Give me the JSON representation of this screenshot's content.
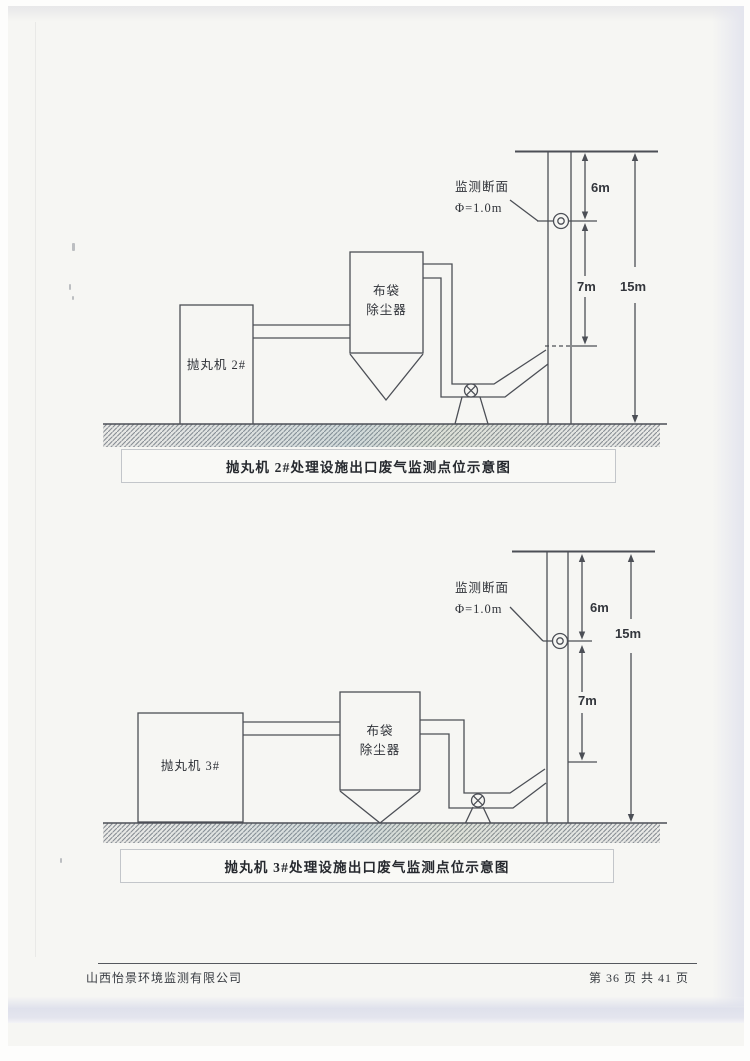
{
  "colors": {
    "paper": "#f6f6f3",
    "line": "#4c4f56",
    "text": "#2f3238",
    "caption_border": "#c3c6ca",
    "bottom_scan_band": "#dfe1ec",
    "ground_hatch": "#878c93"
  },
  "diagram1": {
    "monitor_section_label": "监测断面",
    "diameter_label": "Φ=1.0m",
    "dim_top": "6m",
    "dim_mid": "7m",
    "dim_total": "15m",
    "machine_label": "抛丸机 2#",
    "collector_label_1": "布袋",
    "collector_label_2": "除尘器",
    "caption": "抛丸机 2#处理设施出口废气监测点位示意图"
  },
  "diagram2": {
    "monitor_section_label": "监测断面",
    "diameter_label": "Φ=1.0m",
    "dim_top": "6m",
    "dim_mid": "7m",
    "dim_total": "15m",
    "machine_label": "抛丸机 3#",
    "collector_label_1": "布袋",
    "collector_label_2": "除尘器",
    "caption": "抛丸机 3#处理设施出口废气监测点位示意图"
  },
  "footer": {
    "company": "山西怡景环境监测有限公司",
    "page_info": "第 36 页 共 41 页"
  }
}
